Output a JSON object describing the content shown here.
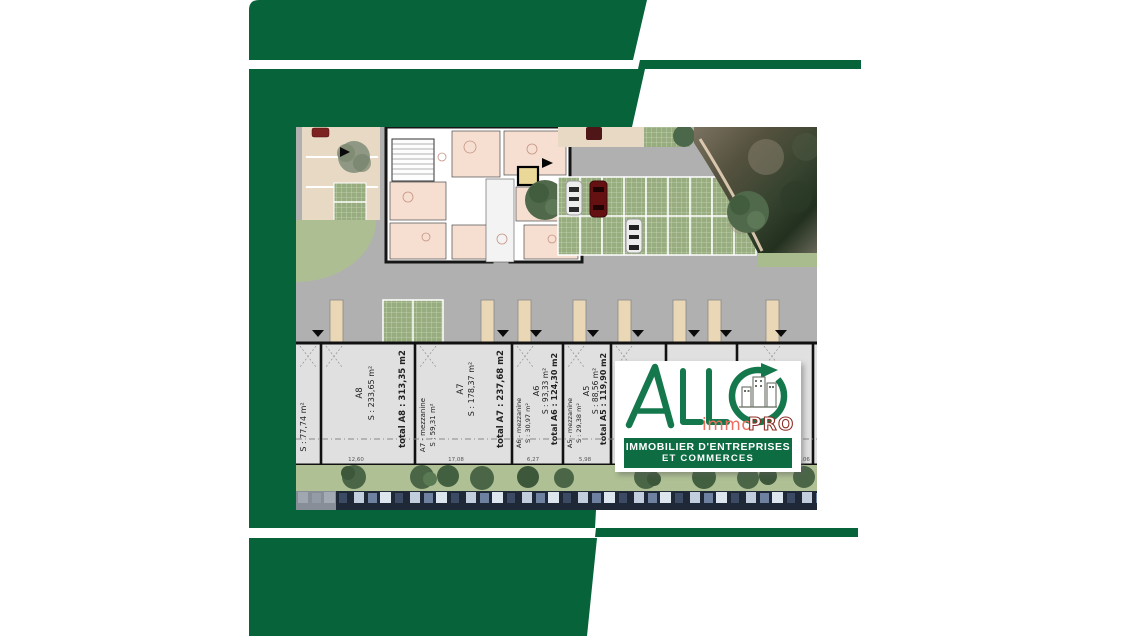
{
  "brand": {
    "wordmark": "ALLO",
    "sub_immo": "immo",
    "sub_pro": "PRO",
    "tagline_line1": "IMMOBILIER D'ENTREPRISES",
    "tagline_line2": "ET COMMERCES"
  },
  "colors": {
    "frame_green": "#076339",
    "logo_green": "#15784c",
    "immo_salmon": "#ee6f5f",
    "pro_maroon": "#8d2e26",
    "banner_green": "#0d6c42"
  },
  "icons": {
    "logo_o_icon": "building-skyline-icon inside circular-arrow-icon",
    "plan_markers": "down-arrow-icon, right-arrow-icon, tree-icon, car-icon"
  },
  "plan": {
    "edge_fragment_area": "S : 77,74 m²",
    "right_edge_dim": "13,06",
    "units": [
      {
        "name": "A8",
        "area": "S : 233,65 m²",
        "mezzanine_name": "",
        "mezzanine_area": "",
        "total": "total A8 : 313,35 m2",
        "dim": "12,60"
      },
      {
        "name": "A7",
        "area": "S : 178,37 m²",
        "mezzanine_name": "A7 - mezzanine",
        "mezzanine_area": "S : 59,31 m²",
        "total": "total A7 : 237,68 m2",
        "dim": "17,08"
      },
      {
        "name": "A6",
        "area": "S : 93,33 m²",
        "mezzanine_name": "A6 - mezzanine",
        "mezzanine_area": "S : 30,97 m²",
        "total": "total A6 : 124,30 m2",
        "dim": "6,27"
      },
      {
        "name": "A5",
        "area": "S : 88,56 m²",
        "mezzanine_name": "A5 - mezzanine",
        "mezzanine_area": "S : 29,38 m²",
        "total": "total A5 : 119,90 m2",
        "dim": "5,98"
      }
    ]
  }
}
